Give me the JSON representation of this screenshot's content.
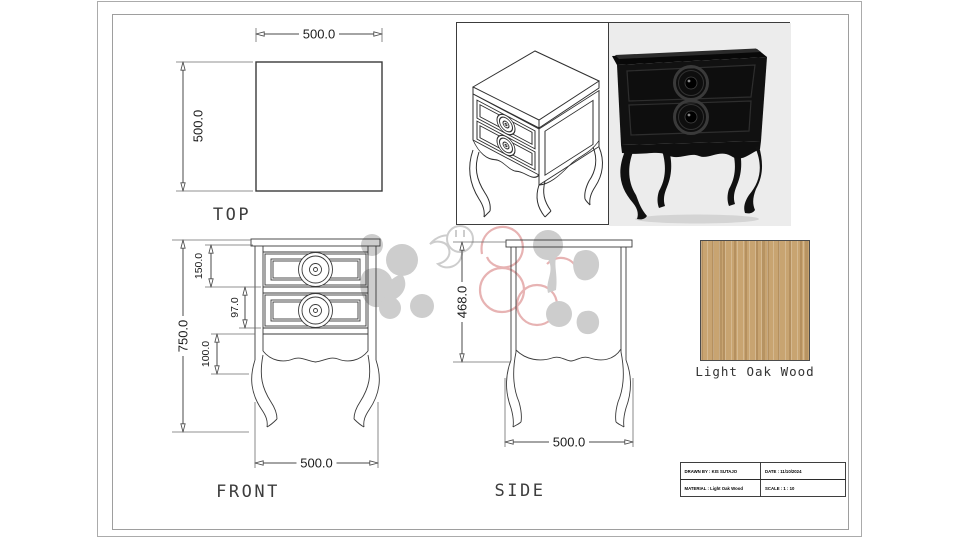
{
  "colors": {
    "wood_base": "#C8A471",
    "watermark_grey": "#CDCDCD",
    "watermark_pink": "#E7B3B3",
    "furniture_black": "#111111",
    "photo_bg": "#ECECEC"
  },
  "views": {
    "top": {
      "label": "TOP",
      "width_dim": "500.0",
      "depth_dim": "500.0"
    },
    "front": {
      "label": "FRONT",
      "height_dim": "750.0",
      "drawer_top_dim": "150.0",
      "drawer_bottom_dim": "97.0",
      "apron_dim": "100.0",
      "width_dim": "500.0"
    },
    "side": {
      "label": "SIDE",
      "height_dim": "468.0",
      "depth_dim": "500.0"
    }
  },
  "material_swatch": {
    "label": "Light Oak Wood"
  },
  "title_block": {
    "drawn_by": "DRAWN BY : KIS SUTAJO",
    "date": "DATE : 11/10/2024",
    "material": "MATERIAL : Light Oak Wood",
    "scale": "SCALE : 1 : 10"
  }
}
